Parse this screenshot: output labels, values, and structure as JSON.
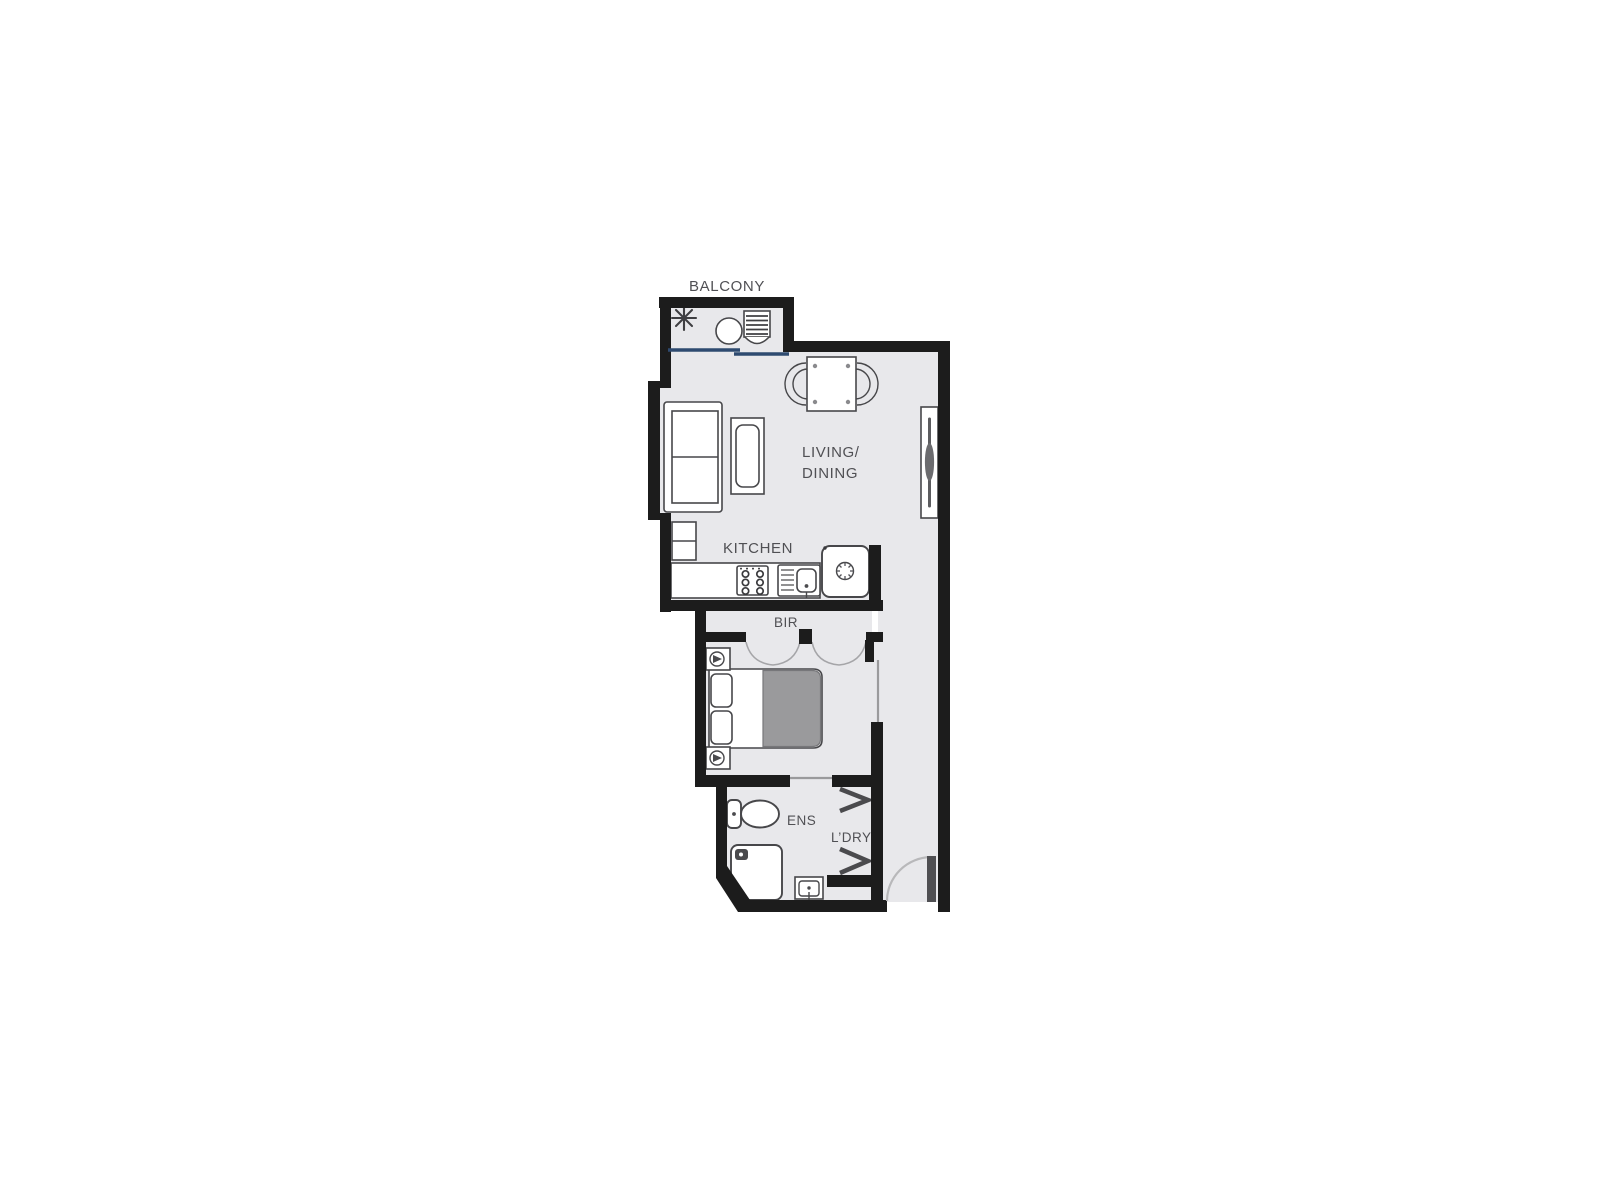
{
  "labels": {
    "balcony": "BALCONY",
    "living_line1": "LIVING/",
    "living_line2": "DINING",
    "kitchen": "KITCHEN",
    "bir": "BIR",
    "ensuite": "ENS",
    "laundry": "L’DRY"
  },
  "colors": {
    "background": "#ffffff",
    "wall": "#1c1c1c",
    "floor": "#e8e8eb",
    "furniture_fill": "#ffffff",
    "furniture_stroke": "#47474a",
    "furniture_dark": "#4a4a4d",
    "blanket": "#9a9a9c",
    "sliding_door": "#2e4a70",
    "door_leaf": "#4f4f52",
    "door_arc": "#b8b8ba",
    "arc_gray": "#a5a5a8",
    "thin_door": "#9a9a9c",
    "text": "#505054"
  }
}
